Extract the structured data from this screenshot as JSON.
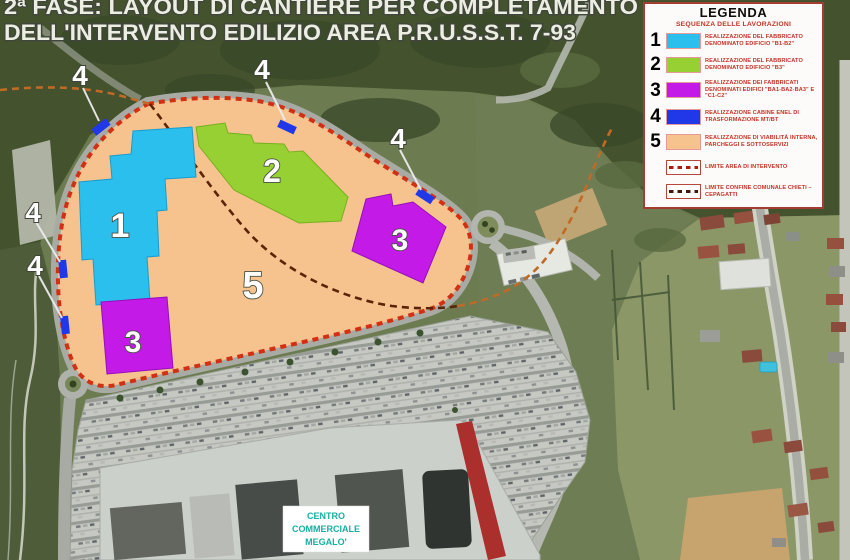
{
  "title": {
    "line1": "2ª FASE: LAYOUT DI CANTIERE PER COMPLETAMENTO",
    "line2": "DELL'INTERVENTO EDILIZIO AREA P.R.U.S.S.T. 7-93"
  },
  "legend": {
    "title": "LEGENDA",
    "subtitle": "SEQUENZA DELLE LAVORAZIONI",
    "items": [
      {
        "number": "1",
        "color": "#2bbfee",
        "label": "REALIZZAZIONE DEL FABBRICATO DENOMINATO EDIFICIO \"B1-B2\""
      },
      {
        "number": "2",
        "color": "#97d032",
        "label": "REALIZZAZIONE DEL FABBRICATO DENOMINATO EDIFICIO \"B3\""
      },
      {
        "number": "3",
        "color": "#c31ae8",
        "label": "REALIZZAZIONE DEI FABBRICATI DENOMINATI EDIFICI \"BA1-BA2-BA3\" E \"C1-C2\""
      },
      {
        "number": "4",
        "color": "#2038e8",
        "label": "REALIZZAZIONE CABINE ENEL DI TRASFORMAZIONE MT/BT"
      },
      {
        "number": "5",
        "color": "#f6c28d",
        "label": "REALIZZAZIONE DI VIABILITÀ INTERNA, PARCHEGGI E SOTTOSERVIZI"
      }
    ],
    "line_items": [
      {
        "label": "LIMITE AREA DI INTERVENTO"
      },
      {
        "label": "LIMITE CONFINE COMUNALE CHIETI – CEPAGATTI"
      }
    ]
  },
  "map": {
    "zones": [
      {
        "label": "1"
      },
      {
        "label": "2"
      },
      {
        "label": "3"
      },
      {
        "label": "3"
      },
      {
        "label": "5"
      }
    ],
    "markers": [
      {
        "label": "4"
      },
      {
        "label": "4"
      },
      {
        "label": "4"
      },
      {
        "label": "4"
      },
      {
        "label": "4"
      }
    ],
    "mall_label": {
      "line1": "CENTRO",
      "line2": "COMMERCIALE",
      "line3": "MEGALO'"
    }
  },
  "colors": {
    "intervention_border": "#d23014",
    "municipal_boundary_inner": "#5a2408",
    "municipal_boundary_outer": "#c06a28"
  }
}
